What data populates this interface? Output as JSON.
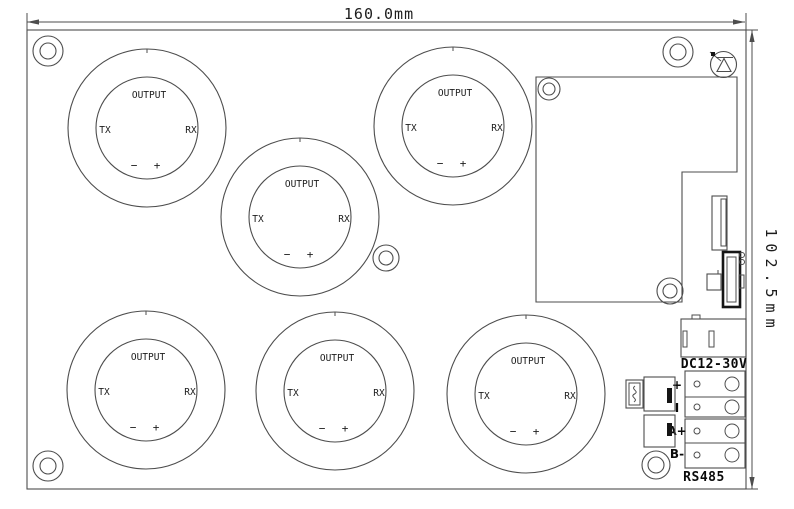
{
  "drawing": {
    "width_dim": "160.0mm",
    "height_dim": "102.5mm"
  },
  "module": {
    "output": "OUTPUT",
    "tx": "TX",
    "rx": "RX",
    "minus": "−",
    "plus": "+"
  },
  "power": {
    "label": "DC12-30V"
  },
  "rs485": {
    "label": "RS485",
    "terminals": [
      "+",
      "I",
      "A+",
      "B-"
    ]
  },
  "colors": {
    "line": "#4d4d4d",
    "dark": "#111111",
    "bg": "#ffffff"
  }
}
